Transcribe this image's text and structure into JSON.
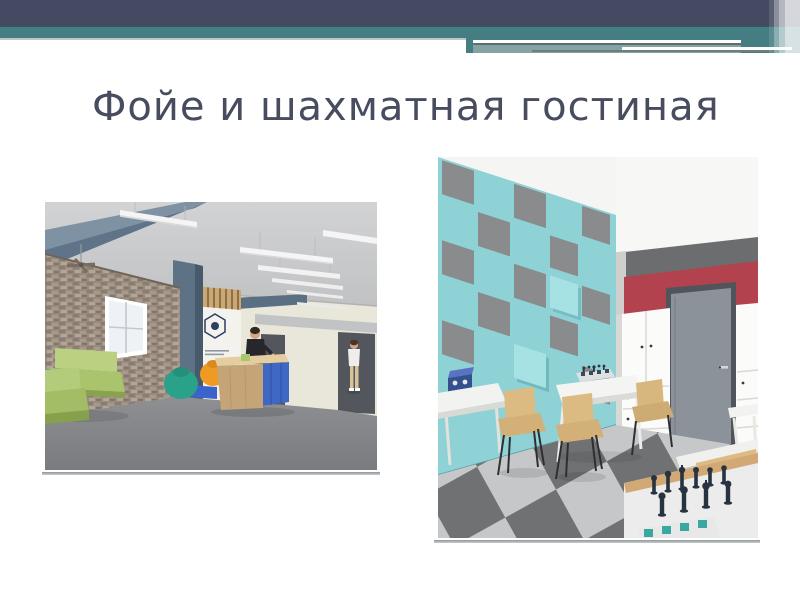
{
  "slide": {
    "title": "Фойе и шахматная гостиная",
    "title_color": "#474c5f",
    "background": "#ffffff",
    "header": {
      "top_bar_color": "#454961",
      "teal_band_color": "#447d82",
      "accent_white": "#ffffff",
      "accent_gray": "#5d6d6f"
    },
    "images": {
      "foyer": {
        "alt": "3D render of the foyer: exposed brick wall with window and ceiling fan, lime-green sofas, teal and orange bean bags, blue-grey column and beams, suspended linear ceiling lights, wooden reception desk with blue panels and receptionist, cream back wall with dark doorways, grey floor, visitor walking",
        "palette": {
          "brick": "#9a8d80",
          "sofa_green": "#b3cc7c",
          "beanbag_teal": "#2aa189",
          "beanbag_orange": "#f09a26",
          "column_blue_gray": "#5d7284",
          "desk_wood": "#c5a478",
          "desk_blue": "#3f68c4",
          "floor_gray": "#85878b",
          "wall_cream": "#e9e7d9"
        }
      },
      "chess_lounge": {
        "alt": "3D render of the chess lounge: turquoise wall with grey square acoustic panels in a checker pattern, white ceiling, red accent wall with grey door, white storage cabinets with drawers, chequered grey floor tiles, white chess tables with pieces, wooden chairs with black legs, blue chess clock",
        "palette": {
          "wall_teal": "#8ed2d6",
          "panel_gray": "#8a8b8d",
          "accent_red": "#b2434e",
          "door_gray": "#8c929a",
          "floor_dark": "#6f7173",
          "floor_light": "#c6c7c9",
          "chair_wood": "#dcbb82",
          "pieces_navy": "#273440",
          "clock_blue": "#3a57a8"
        }
      }
    }
  }
}
